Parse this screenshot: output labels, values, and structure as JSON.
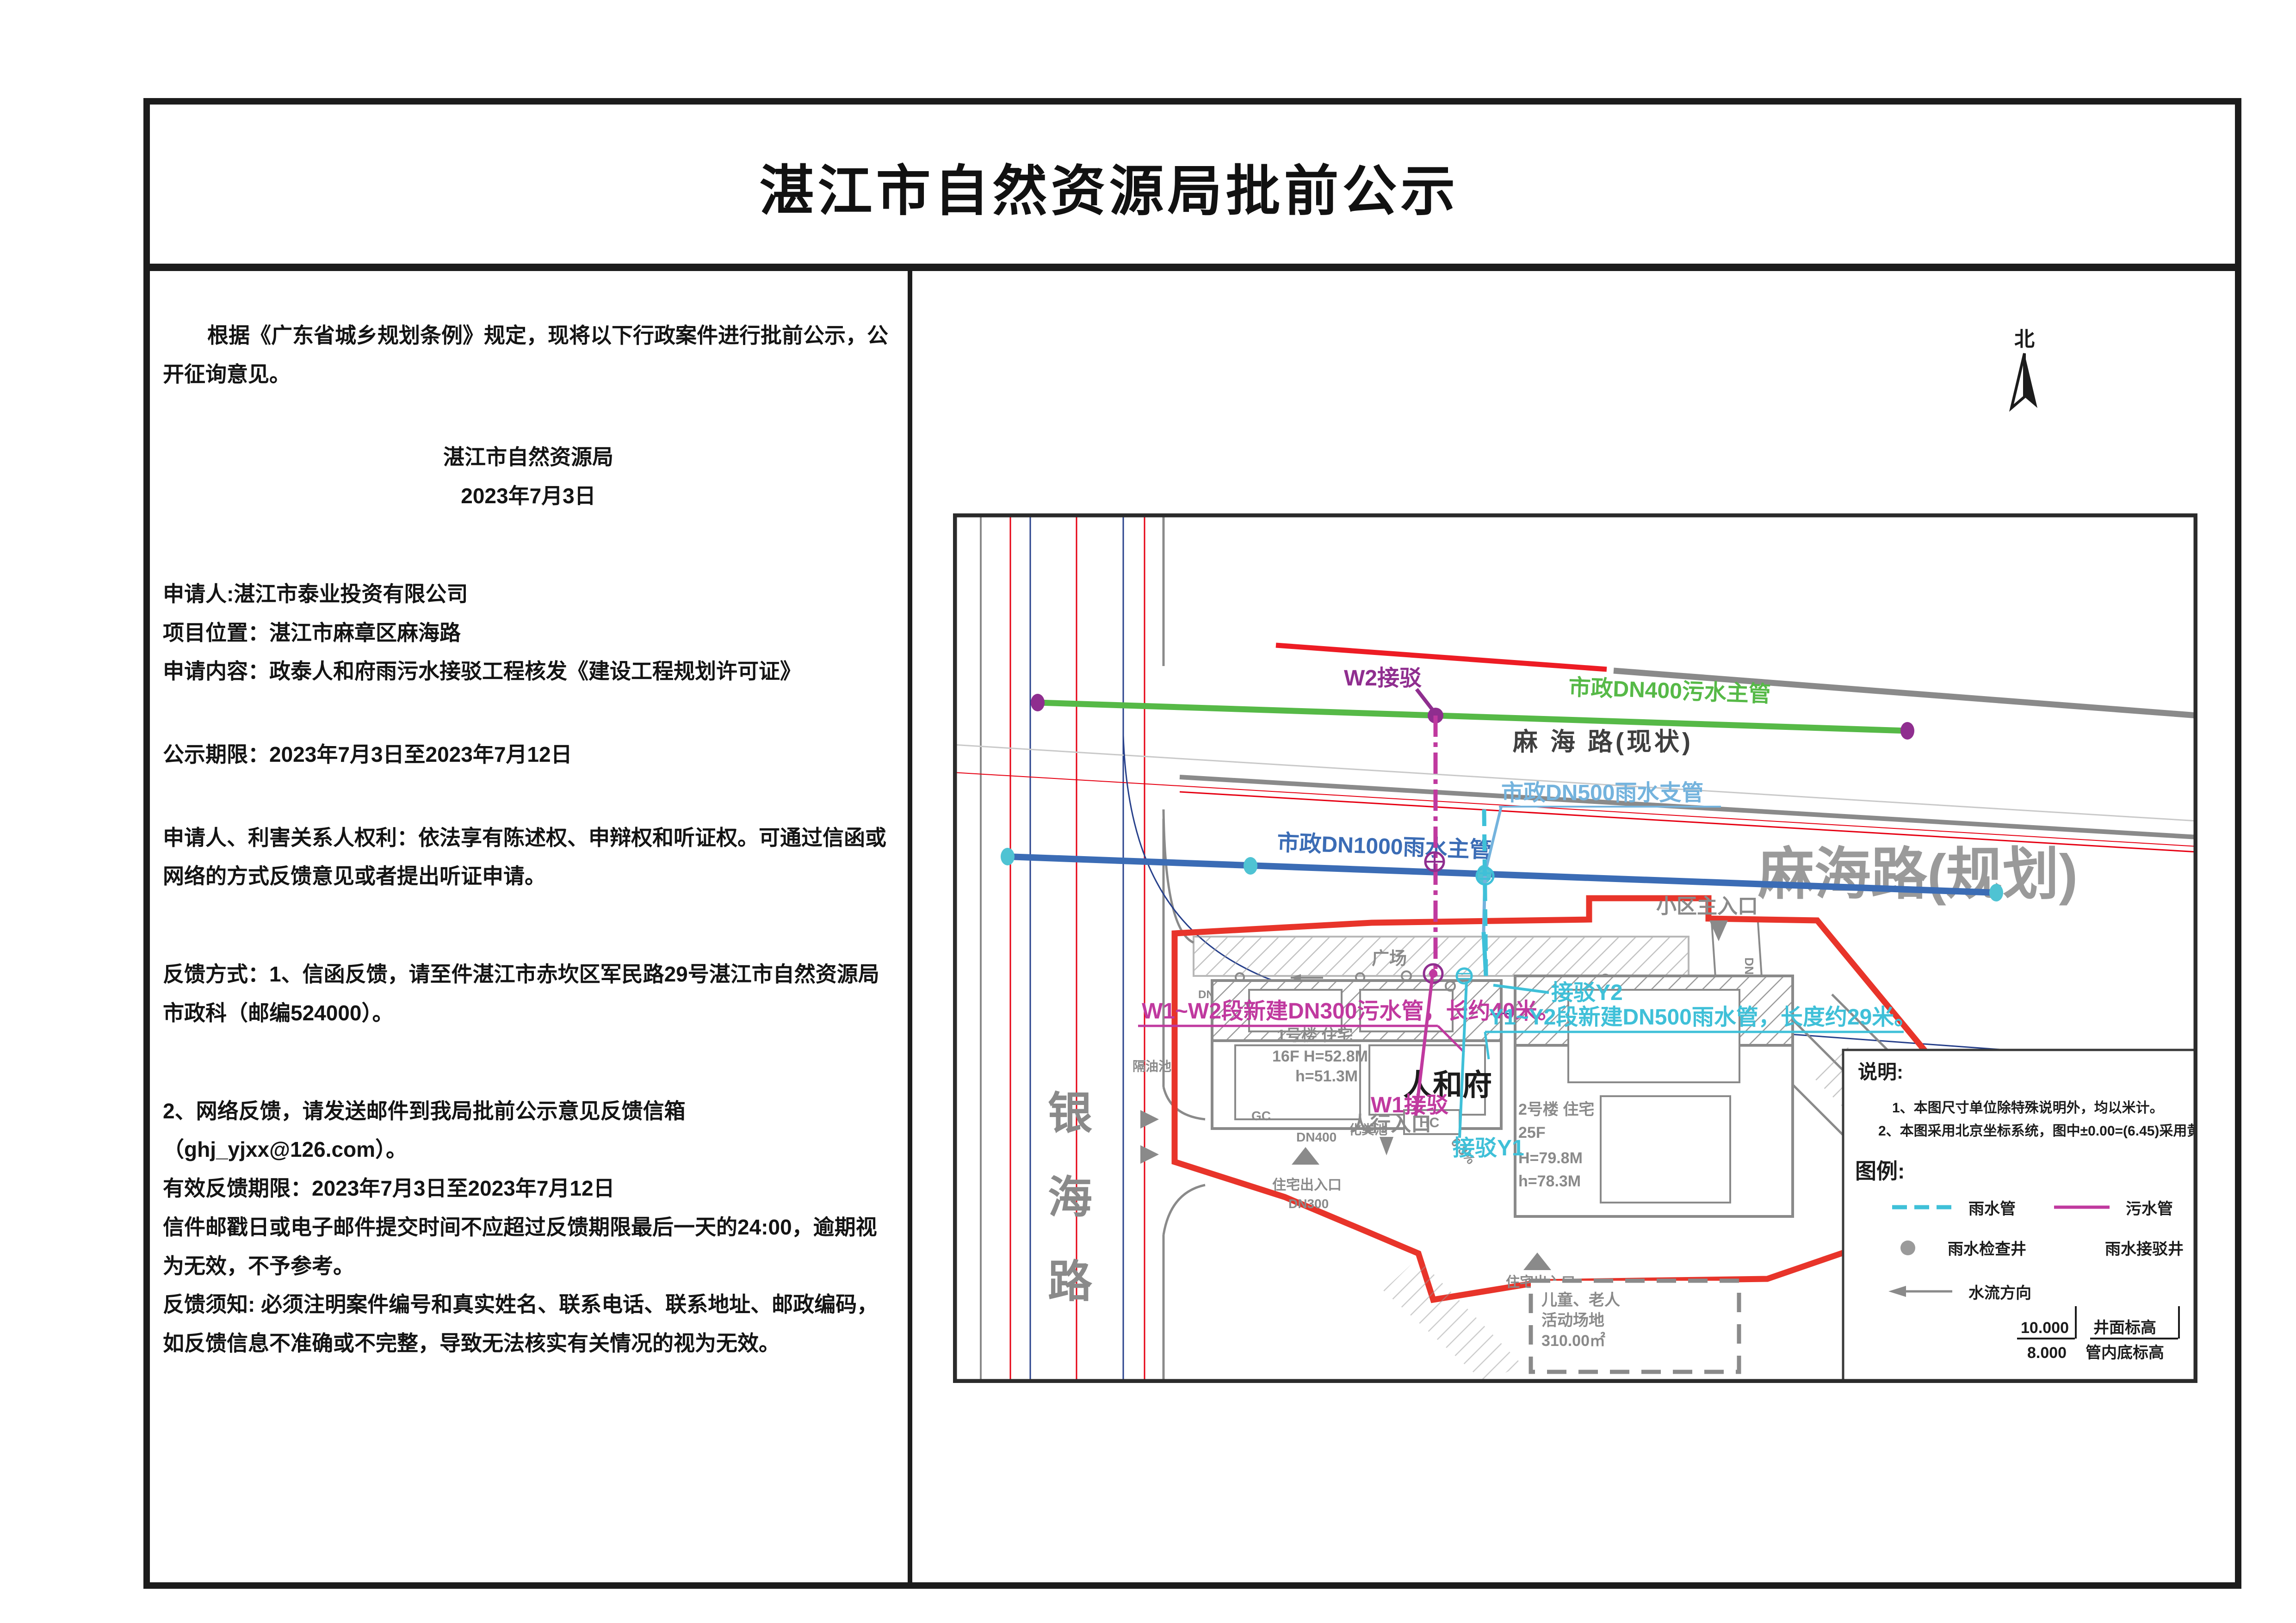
{
  "title": "湛江市自然资源局批前公示",
  "notice": {
    "intro": "根据《广东省城乡规划条例》规定，现将以下行政案件进行批前公示，公开征询意见。",
    "agency": "湛江市自然资源局",
    "date": "2023年7月3日",
    "applicant": "申请人:湛江市泰业投资有限公司",
    "location": "项目位置：湛江市麻章区麻海路",
    "content": "申请内容：政泰人和府雨污水接驳工程核发《建设工程规划许可证》",
    "period": "公示期限：2023年7月3日至2023年7月12日",
    "rights": "申请人、利害关系人权利：依法享有陈述权、申辩权和听证权。可通过信函或网络的方式反馈意见或者提出听证申请。",
    "feedback_mail": "反馈方式：1、信函反馈，请至件湛江市赤坎区军民路29号湛江市自然资源局市政科（邮编524000）。",
    "feedback_online": "2、网络反馈，请发送邮件到我局批前公示意见反馈信箱（ghj_yjxx@126.com）。",
    "valid_period": "有效反馈期限：2023年7月3日至2023年7月12日",
    "deadline_note": "信件邮戳日或电子邮件提交时间不应超过反馈期限最后一天的24:00，逾期视为无效，不予参考。",
    "feedback_notice": "反馈须知: 必须注明案件编号和真实姓名、联系电话、联系地址、邮政编码，如反馈信息不准确或不完整，导致无法核实有关情况的视为无效。"
  },
  "map": {
    "compass": "北",
    "roads": {
      "yinhai_chars": [
        "银",
        "海",
        "路"
      ],
      "mahai_existing": "麻 海 路(现状)",
      "mahai_planned": "麻海路(规划)"
    },
    "pipes": {
      "sewage_main": "市政DN400污水主管",
      "rain_main": "市政DN1000雨水主管",
      "rain_branch": "市政DN500雨水支管",
      "new_sewage": "W1~W2段新建DN300污水管，长约40米。",
      "new_rain": "Y1~Y2段新建DN500雨水管，长度约29米。",
      "w2_label": "W2接驳",
      "w1_label": "W1接驳",
      "y2_label": "接驳Y2",
      "y1_label": "接驳Y1"
    },
    "site": {
      "name": "人和府",
      "plaza": "广场",
      "b1_line1": "1号楼 住宅",
      "b1_line2": "16F H=52.8M",
      "b1_line3": "h=51.3M",
      "b2_line1": "2号楼 住宅",
      "b2_line2": "25F",
      "b2_line3": "H=79.8M",
      "b2_line4": "h=78.3M",
      "entry_ped": "人行入口",
      "entry_main": "小区主入口",
      "entry_res": "住宅出入口",
      "geyouchi": "隔油池",
      "huafenchi": "化粪池",
      "hc": "HC",
      "gc": "GC",
      "dn300": "DN300",
      "dn400": "DN400",
      "dn800": "DN800",
      "slope": "0.3%",
      "activity_line1": "儿童、老人",
      "activity_line2": "活动场地",
      "activity_line3": "310.00㎡"
    },
    "legend": {
      "shuoming": "说明:",
      "note1": "1、本图尺寸单位除特殊说明外，均以米计。",
      "note2": "2、本图采用北京坐标系统，图中±0.00=(6.45)采用黄海高程系统。",
      "tuli": "图例:",
      "rain_pipe": "雨水管",
      "sewage_pipe": "污水管",
      "rain_well": "雨水检查井",
      "rain_conn_well": "雨水接驳井",
      "flow_dir": "水流方向",
      "elev_top": "10.000",
      "elev_bottom": "8.000",
      "elev_label_top": "井面标高",
      "elev_label_bottom": "管内底标高"
    },
    "colors": {
      "boundary_red": "#e8342a",
      "sewage_green": "#56b947",
      "rain_blue": "#3b6cb5",
      "branch_steelblue": "#74b3dd",
      "new_rain_cyan": "#3fc0d8",
      "new_sewage_magenta": "#c0399f",
      "connect_purple": "#8f2e8f",
      "road_gray": "#8a8a8a"
    }
  }
}
